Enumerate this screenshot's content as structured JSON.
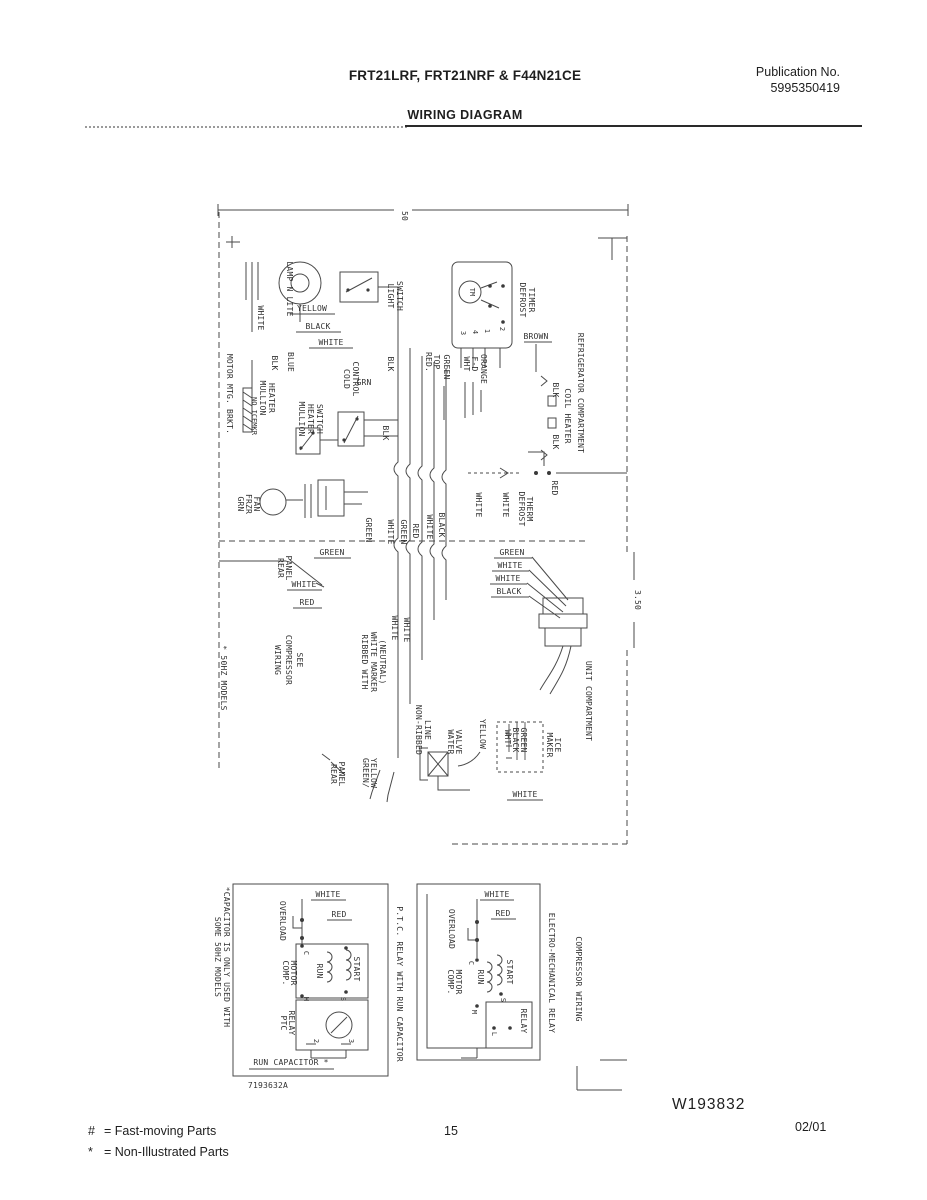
{
  "header": {
    "models_line": "FRT21LRF, FRT21NRF & F44N21CE",
    "publication_label": "Publication No.",
    "publication_number": "5995350419",
    "page_title": "WIRING DIAGRAM"
  },
  "main_diagram": {
    "dimension_top": "50",
    "dimension_right": "3.50",
    "refrigerator_compartment": "REFRIGERATOR COMPARTMENT",
    "unit_compartment": "UNIT COMPARTMENT",
    "lamp_label": "LAMP N LITE",
    "light_switch": {
      "l1": "LIGHT",
      "l2": "SWITCH"
    },
    "defrost_timer": {
      "l1": "DEFROST",
      "l2": "TIMER",
      "dial": "TM",
      "t1": "1",
      "t2": "2",
      "t3": "3",
      "t4": "4"
    },
    "cold_control": {
      "l1": "COLD",
      "l2": "CONTROL"
    },
    "mullion_heater_switch": {
      "l1": "MULLION",
      "l2": "HEATER",
      "l3": "SWITCH"
    },
    "mullion_heater": {
      "l1": "MULLION",
      "l2": "HEATER",
      "l3": "NO ICEMKR"
    },
    "motor_mtg_brkt": "MOTOR MTG. BRKT.",
    "frzr_fan": {
      "wire": "GRN",
      "l1": "FRZR",
      "l2": "FAN"
    },
    "defrost_therm": {
      "l1": "DEFROST",
      "l2": "THERM",
      "w1": "WHITE",
      "w2": "WHITE",
      "w3": "RED"
    },
    "coil_heater": {
      "w1": "BLK",
      "w2": "BLK",
      "label": "COIL HEATER"
    },
    "rear_panel_upper": {
      "l1": "REAR",
      "l2": "PANEL"
    },
    "rear_panel_lower": {
      "l1": "REAR",
      "l2": "PANEL"
    },
    "see_compressor_wiring": {
      "l1": "SEE",
      "l2": "COMPRESSOR",
      "l3": "WIRING"
    },
    "models_note": "* 50HZ MODELS",
    "ribbed_note": {
      "l1": "RIBBED WITH",
      "l2": "WHITE MARKER",
      "l3": "(NEUTRAL)"
    },
    "non_ribbed_line": {
      "l1": "NON-RIBBED",
      "l2": "LINE"
    },
    "green_yellow": {
      "l1": "GREEN/",
      "l2": "YELLOW"
    },
    "ice_maker": {
      "l1": "ICE",
      "l2": "MAKER",
      "w1": "GREEN",
      "w2": "BLACK",
      "w3": "WHT",
      "w4": "WHITE"
    },
    "water_valve": {
      "l1": "WATER",
      "l2": "VALVE",
      "wire": "YELLOW"
    },
    "lamp_wires": {
      "w1": "WHITE",
      "w2": "YELLOW",
      "w3": "BLACK",
      "w4": "WHITE"
    },
    "timer_wires": {
      "w1": "RED.",
      "w2": "TOP",
      "w3": "GREEN",
      "w4": "WHT",
      "w5": "F-D",
      "w6": "ORANGE",
      "w7": "BROWN"
    },
    "control_wires": {
      "w1": "GRN",
      "w2": "BLK",
      "w3": "BLUE",
      "w4": "BLK",
      "w5": "BLK"
    },
    "bundle_wires": {
      "w1": "GREEN",
      "w2": "WHITE",
      "w3": "GREEN",
      "w4": "RED",
      "w5": "WHITE",
      "w6": "BLACK"
    },
    "harness_wires": {
      "w1": "GREEN",
      "w2": "WHITE",
      "w3": "WHITE",
      "w4": "BLACK"
    },
    "rear_panel_wires": {
      "w1": "GREEN",
      "w2": "WHITE",
      "w3": "RED"
    },
    "neutral_wires": {
      "w1": "WHITE",
      "w2": "WHITE"
    }
  },
  "ptc_diagram": {
    "title": "P.T.C. RELAY WITH RUN CAPACITOR",
    "white": "WHITE",
    "red": "RED",
    "overload": "OVERLOAD",
    "comp_motor": {
      "l1": "COMP.",
      "l2": "MOTOR"
    },
    "ptc_relay": {
      "l1": "PTC",
      "l2": "RELAY"
    },
    "run": "RUN",
    "start": "START",
    "run_capacitor": "RUN CAPACITOR *",
    "terminals": {
      "c": "C",
      "s": "S",
      "m": "M",
      "t2": "2",
      "t3": "3"
    },
    "note": {
      "l1": "*CAPACITOR IS ONLY USED WITH",
      "l2": "SOME 50HZ MODELS"
    },
    "part_number": "7193632A"
  },
  "em_diagram": {
    "title": "ELECTRO-MECHANICAL RELAY",
    "side_title": "COMPRESSOR WIRING",
    "white": "WHITE",
    "red": "RED",
    "overload": "OVERLOAD",
    "comp_motor": {
      "l1": "COMP.",
      "l2": "MOTOR"
    },
    "relay": "RELAY",
    "run": "RUN",
    "start": "START",
    "terminals": {
      "c": "C",
      "s": "S",
      "m": "M",
      "l": "L"
    }
  },
  "footer": {
    "drawing_number": "W193832",
    "page_number": "15",
    "date_code": "02/01",
    "legend": [
      {
        "symbol": "#",
        "text": "=  Fast-moving Parts"
      },
      {
        "symbol": "*",
        "text": "=  Non-Illustrated Parts"
      }
    ]
  }
}
